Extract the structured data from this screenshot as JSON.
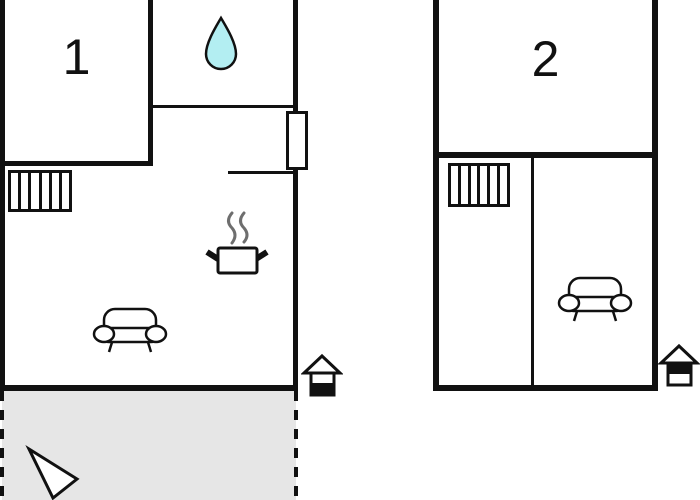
{
  "image_type": "apartment floor plans",
  "colors": {
    "wall": "#111111",
    "water_drop_fill": "#b3eef2",
    "terrace_fill": "#e6e6e6",
    "steam": "#6e6e6e",
    "background": "#ffffff"
  },
  "plans": [
    {
      "unit_label": "1",
      "icons": [
        "water-drop",
        "stairs",
        "cooking-pot-with-steam",
        "sofa",
        "door",
        "ground-floor-house",
        "north-arrow"
      ]
    },
    {
      "unit_label": "2",
      "icons": [
        "stairs",
        "sofa",
        "upper-floor-house"
      ]
    }
  ]
}
